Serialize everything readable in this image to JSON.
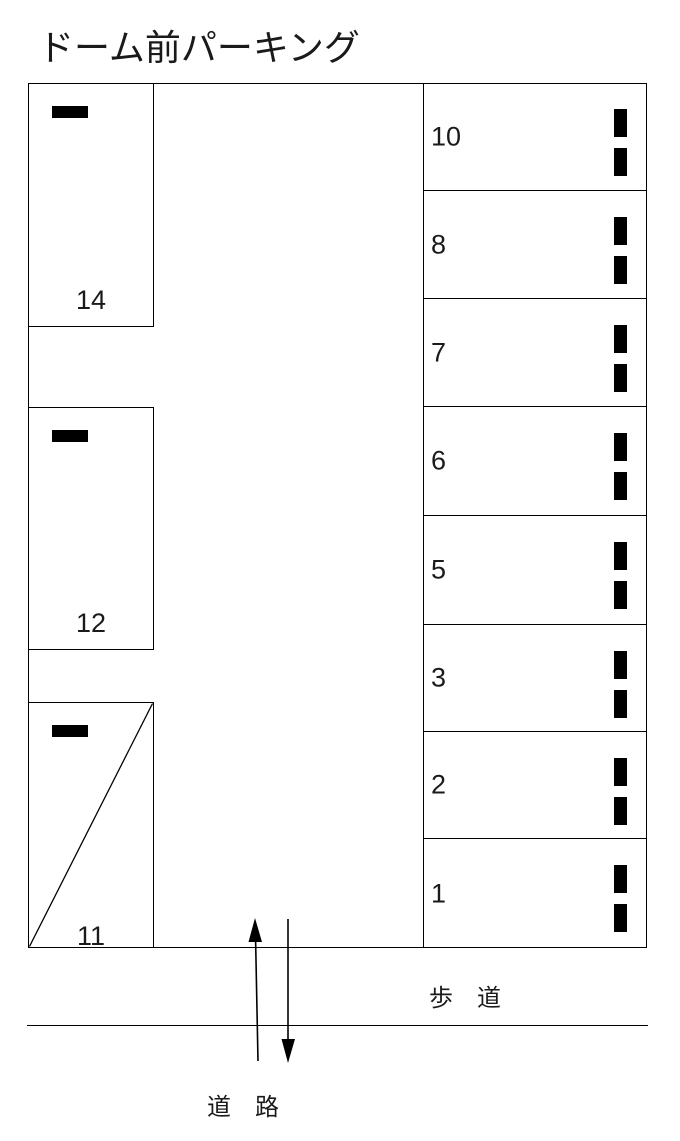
{
  "title": "ドーム前パーキング",
  "parking": {
    "left_spaces": [
      {
        "number": "14"
      },
      {
        "number": "12"
      },
      {
        "number": "11"
      }
    ],
    "right_spaces": [
      {
        "number": "10"
      },
      {
        "number": "8"
      },
      {
        "number": "7"
      },
      {
        "number": "6"
      },
      {
        "number": "5"
      },
      {
        "number": "3"
      },
      {
        "number": "2"
      },
      {
        "number": "1"
      }
    ]
  },
  "labels": {
    "sidewalk": "歩　道",
    "road": "道　路"
  },
  "icons": {
    "wheel_stop": "black-bar",
    "up_arrow": "thin-vertical-arrow-up",
    "down_arrow": "thin-vertical-arrow-down"
  },
  "colors": {
    "line": "#000000",
    "text": "#1a1a1a",
    "background": "#ffffff"
  }
}
